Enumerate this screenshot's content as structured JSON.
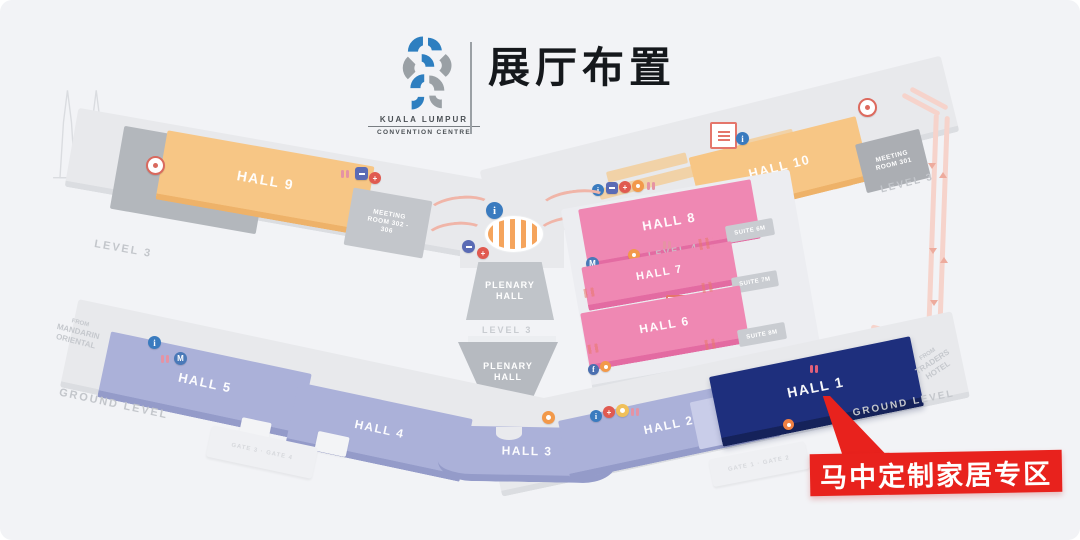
{
  "header": {
    "brand": {
      "line1": "KUALA LUMPUR",
      "line2": "CONVENTION CENTRE"
    },
    "title": "展厅布置"
  },
  "annotation": {
    "label": "马中定制家居专区"
  },
  "map": {
    "halls": {
      "hall1": "HALL 1",
      "hall2": "HALL 2",
      "hall3": "HALL 3",
      "hall4": "HALL 4",
      "hall5": "HALL 5",
      "hall6": "HALL 6",
      "hall7": "HALL 7",
      "hall8": "HALL 8",
      "hall9": "HALL 9",
      "hall10": "HALL 10"
    },
    "rooms": {
      "plenary_theatre": "PLENARY THEATRE",
      "plenary_hall_l3": "PLENARY HALL",
      "plenary_hall_l1": "PLENARY HALL",
      "meeting_room_west": "MEETING ROOM 302 - 306",
      "meeting_room_east": "MEETING ROOM 301",
      "suite_6m": "SUITE 6M",
      "suite_7m": "SUITE 7M",
      "suite_8m": "SUITE 8M",
      "gate_west": "GATE 3 · GATE 4",
      "gate_east": "GATE 1 · GATE 2"
    },
    "levels": {
      "level3_west": "LEVEL 3",
      "level3_center": "LEVEL 3",
      "level3_east": "LEVEL 3",
      "level4": "LEVEL 4",
      "level1": "LEVEL 1",
      "ground_west": "GROUND LEVEL",
      "ground_east": "GROUND LEVEL"
    },
    "directions": {
      "mandarin": [
        "FROM",
        "MANDARIN",
        "ORIENTAL"
      ],
      "traders": [
        "FROM",
        "TRADERS",
        "HOTEL"
      ]
    },
    "icons": {
      "info": "i",
      "first_aid": "+",
      "metro": "M",
      "facility": "f"
    }
  },
  "colors": {
    "accent_red": "#e8221d",
    "hall1_navy": "#1e2f7d",
    "hall_orange": "#f7c685",
    "hall_pink": "#ef88b3",
    "hall_lavender": "#abb1d9",
    "logo_blue": "#2e7fc0",
    "logo_gray": "#9aa0a5"
  }
}
